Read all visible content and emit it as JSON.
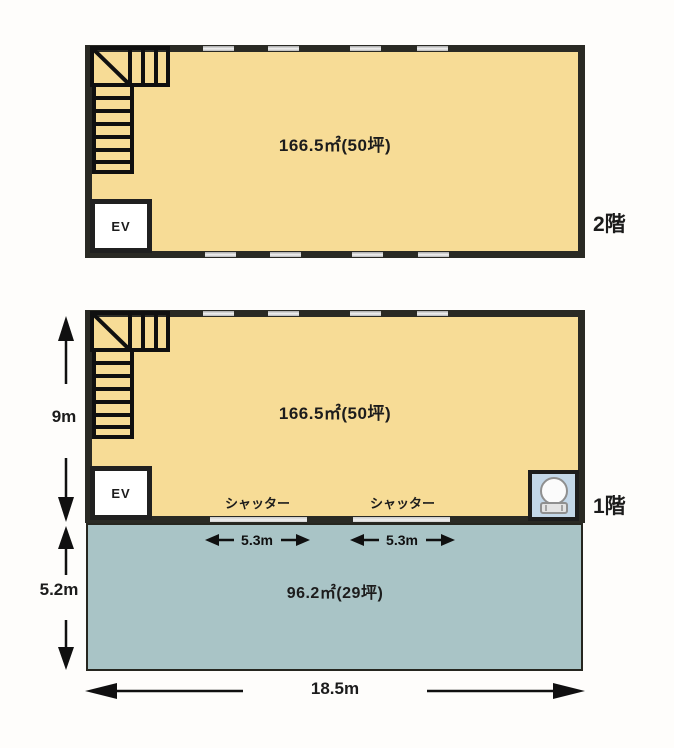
{
  "title": "建物平面図",
  "colors": {
    "floor_fill": "#f7dc96",
    "ground_fill": "#a9c4c6",
    "wall": "#2a2a24",
    "toilet_box": "#c3d7e8"
  },
  "floor2": {
    "label": "2階",
    "area_label": "166.5㎡(50坪)",
    "ev_label": "EV"
  },
  "floor1": {
    "label": "1階",
    "area_label": "166.5㎡(50坪)",
    "ev_label": "EV",
    "shutters": [
      {
        "label": "シャッター",
        "dimension": "5.3m"
      },
      {
        "label": "シャッター",
        "dimension": "5.3m"
      }
    ]
  },
  "ground": {
    "area_label": "96.2㎡(29坪)"
  },
  "dimensions": {
    "upper_height": "9m",
    "lower_height": "5.2m",
    "total_width": "18.5m"
  }
}
